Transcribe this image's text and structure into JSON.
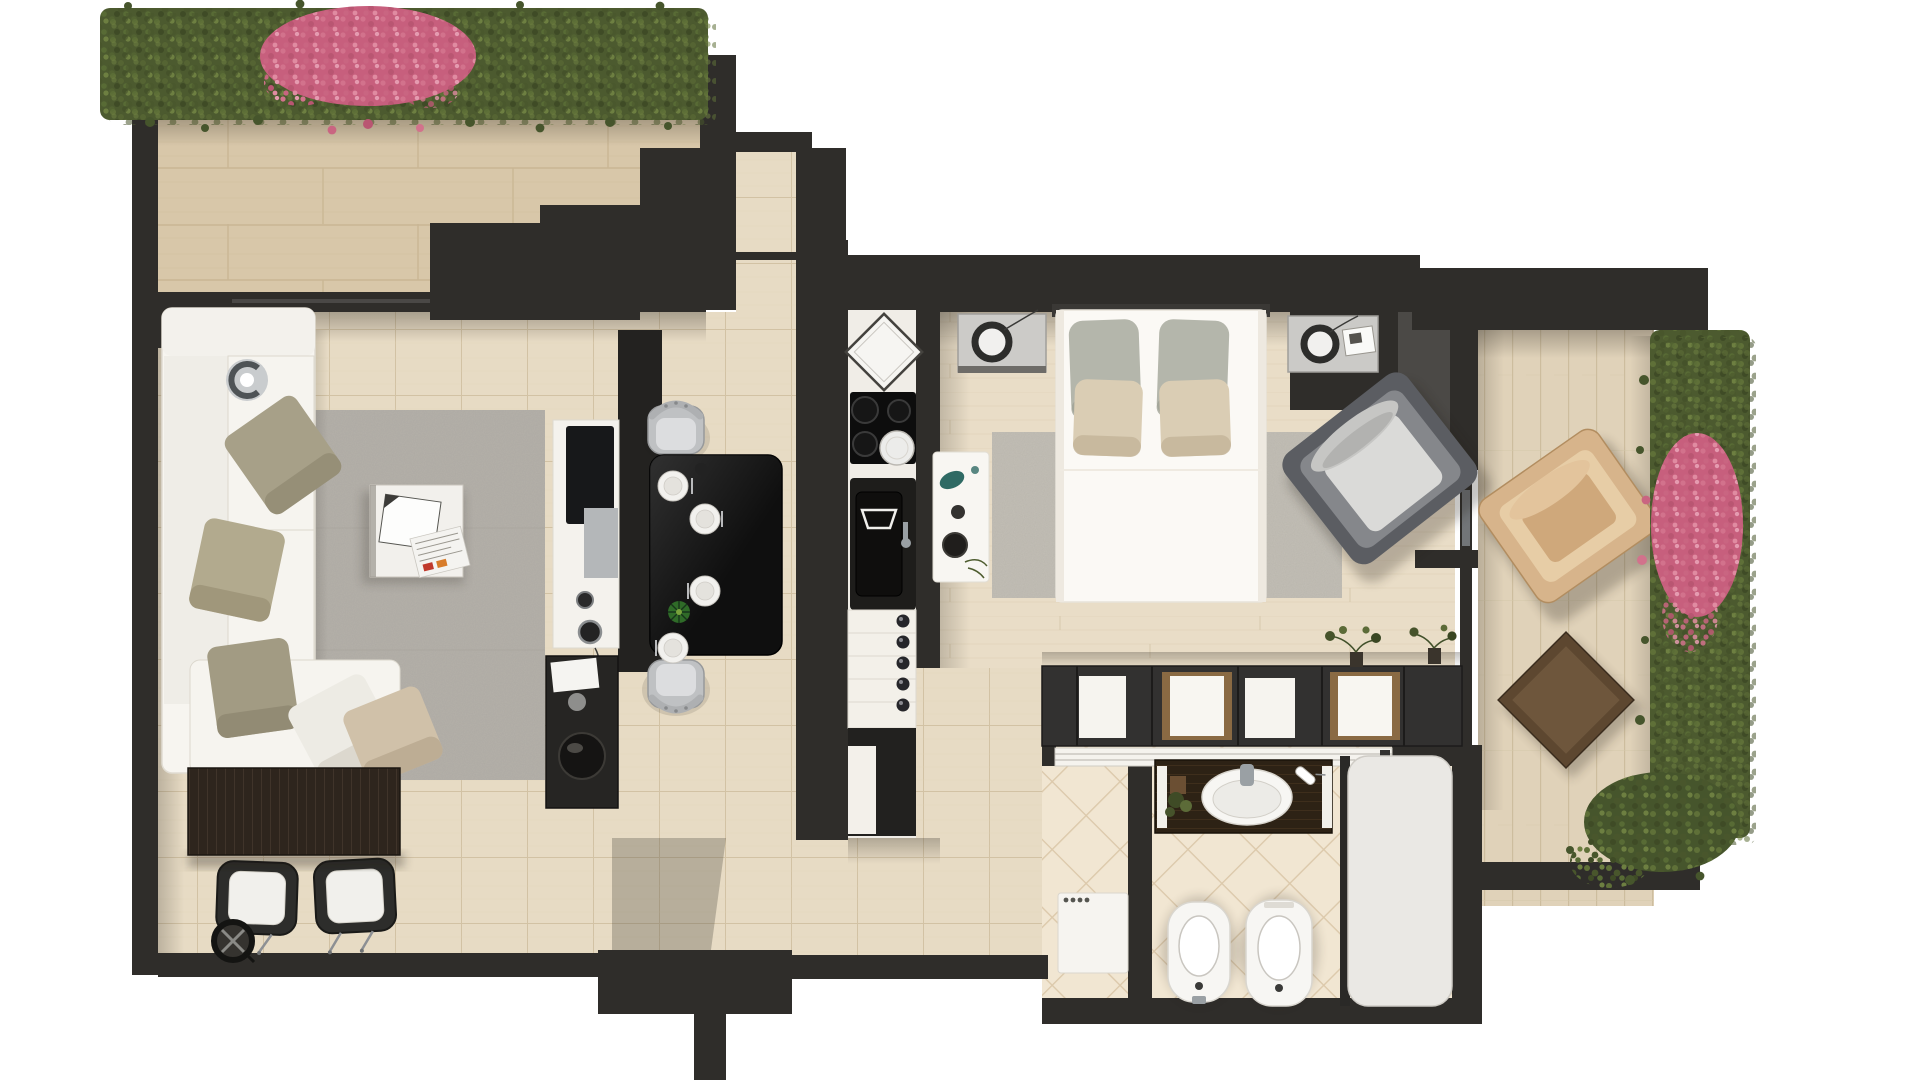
{
  "scene": {
    "kind": "apartment-floor-plan-render",
    "view": "top-down-3d",
    "canvas": {
      "width": 1920,
      "height": 1080
    },
    "background": "#ffffff"
  },
  "palette": {
    "wall": "#2f2d2a",
    "wall_dark": "#1d1c1a",
    "floor_terrace_tl": "#d8c7a9",
    "floor_living": "#e7dbc4",
    "floor_bedroom": "#e9ddc7",
    "floor_bath": "#f1e6d2",
    "floor_terrace_right": "#e0d2b9",
    "rug_living": "#b5b1aa",
    "rug_bedroom": "#c3bfb6",
    "hedge_green": "#4c5a2f",
    "hedge_green_dark": "#46552c",
    "flower_pink": "#c75f7d",
    "sofa_white": "#f7f5f0",
    "bed_white": "#fbf9f5",
    "table_black": "#0f0f0f",
    "chair_silver": "#bfc1c3",
    "sideboard_brown": "#2e251d",
    "vanity_brown": "#2d2215",
    "fixture_white": "#f7f6f3",
    "chrome": "#9aa0a4",
    "tan_chair": "#d7b48b",
    "side_table_brown": "#5d4730",
    "accent_teal": "#2f6a64",
    "plant_green": "#4e5c2f",
    "pillow_olive": "#a7a088",
    "pillow_beige": "#d0c1a9"
  },
  "rooms": [
    {
      "id": "terrace-top",
      "items": [
        "hedge-planter",
        "pink-flower-bush",
        "tiled-deck"
      ]
    },
    {
      "id": "living-room",
      "items": [
        "corner-sofa",
        "olive-pillows",
        "area-rug",
        "coffee-table",
        "magazines",
        "tv-lowboard",
        "tv",
        "speakers",
        "media-shelf",
        "sideboard",
        "two-guest-chairs",
        "round-fan-clock",
        "decor-ring"
      ]
    },
    {
      "id": "dining-kitchen",
      "items": [
        "black-dining-table",
        "four-silver-chairs",
        "four-place-settings",
        "green-centerpiece",
        "sink-diamond-basin",
        "cooktop",
        "kitchen-sink-unit",
        "drawer-unit",
        "base-cabinet"
      ]
    },
    {
      "id": "bedroom",
      "items": [
        "double-bed",
        "two-pillow-pairs",
        "nightstand-left",
        "nightstand-right",
        "ring-lamps",
        "book",
        "area-rug",
        "accessory-table",
        "lounge-armchair"
      ]
    },
    {
      "id": "wardrobe-wall",
      "items": [
        "open-shelf-cabinets",
        "storage-boxes",
        "bonsai-plants"
      ]
    },
    {
      "id": "bathroom",
      "items": [
        "sliding-door",
        "vanity-with-oval-sink",
        "plant",
        "toothbrush-cup",
        "washing-machine",
        "bidet",
        "toilet",
        "bathtub"
      ]
    },
    {
      "id": "terrace-right",
      "items": [
        "plank-deck",
        "tan-armchair",
        "brown-side-table",
        "hedge-planter",
        "pink-flower-bush"
      ]
    }
  ]
}
